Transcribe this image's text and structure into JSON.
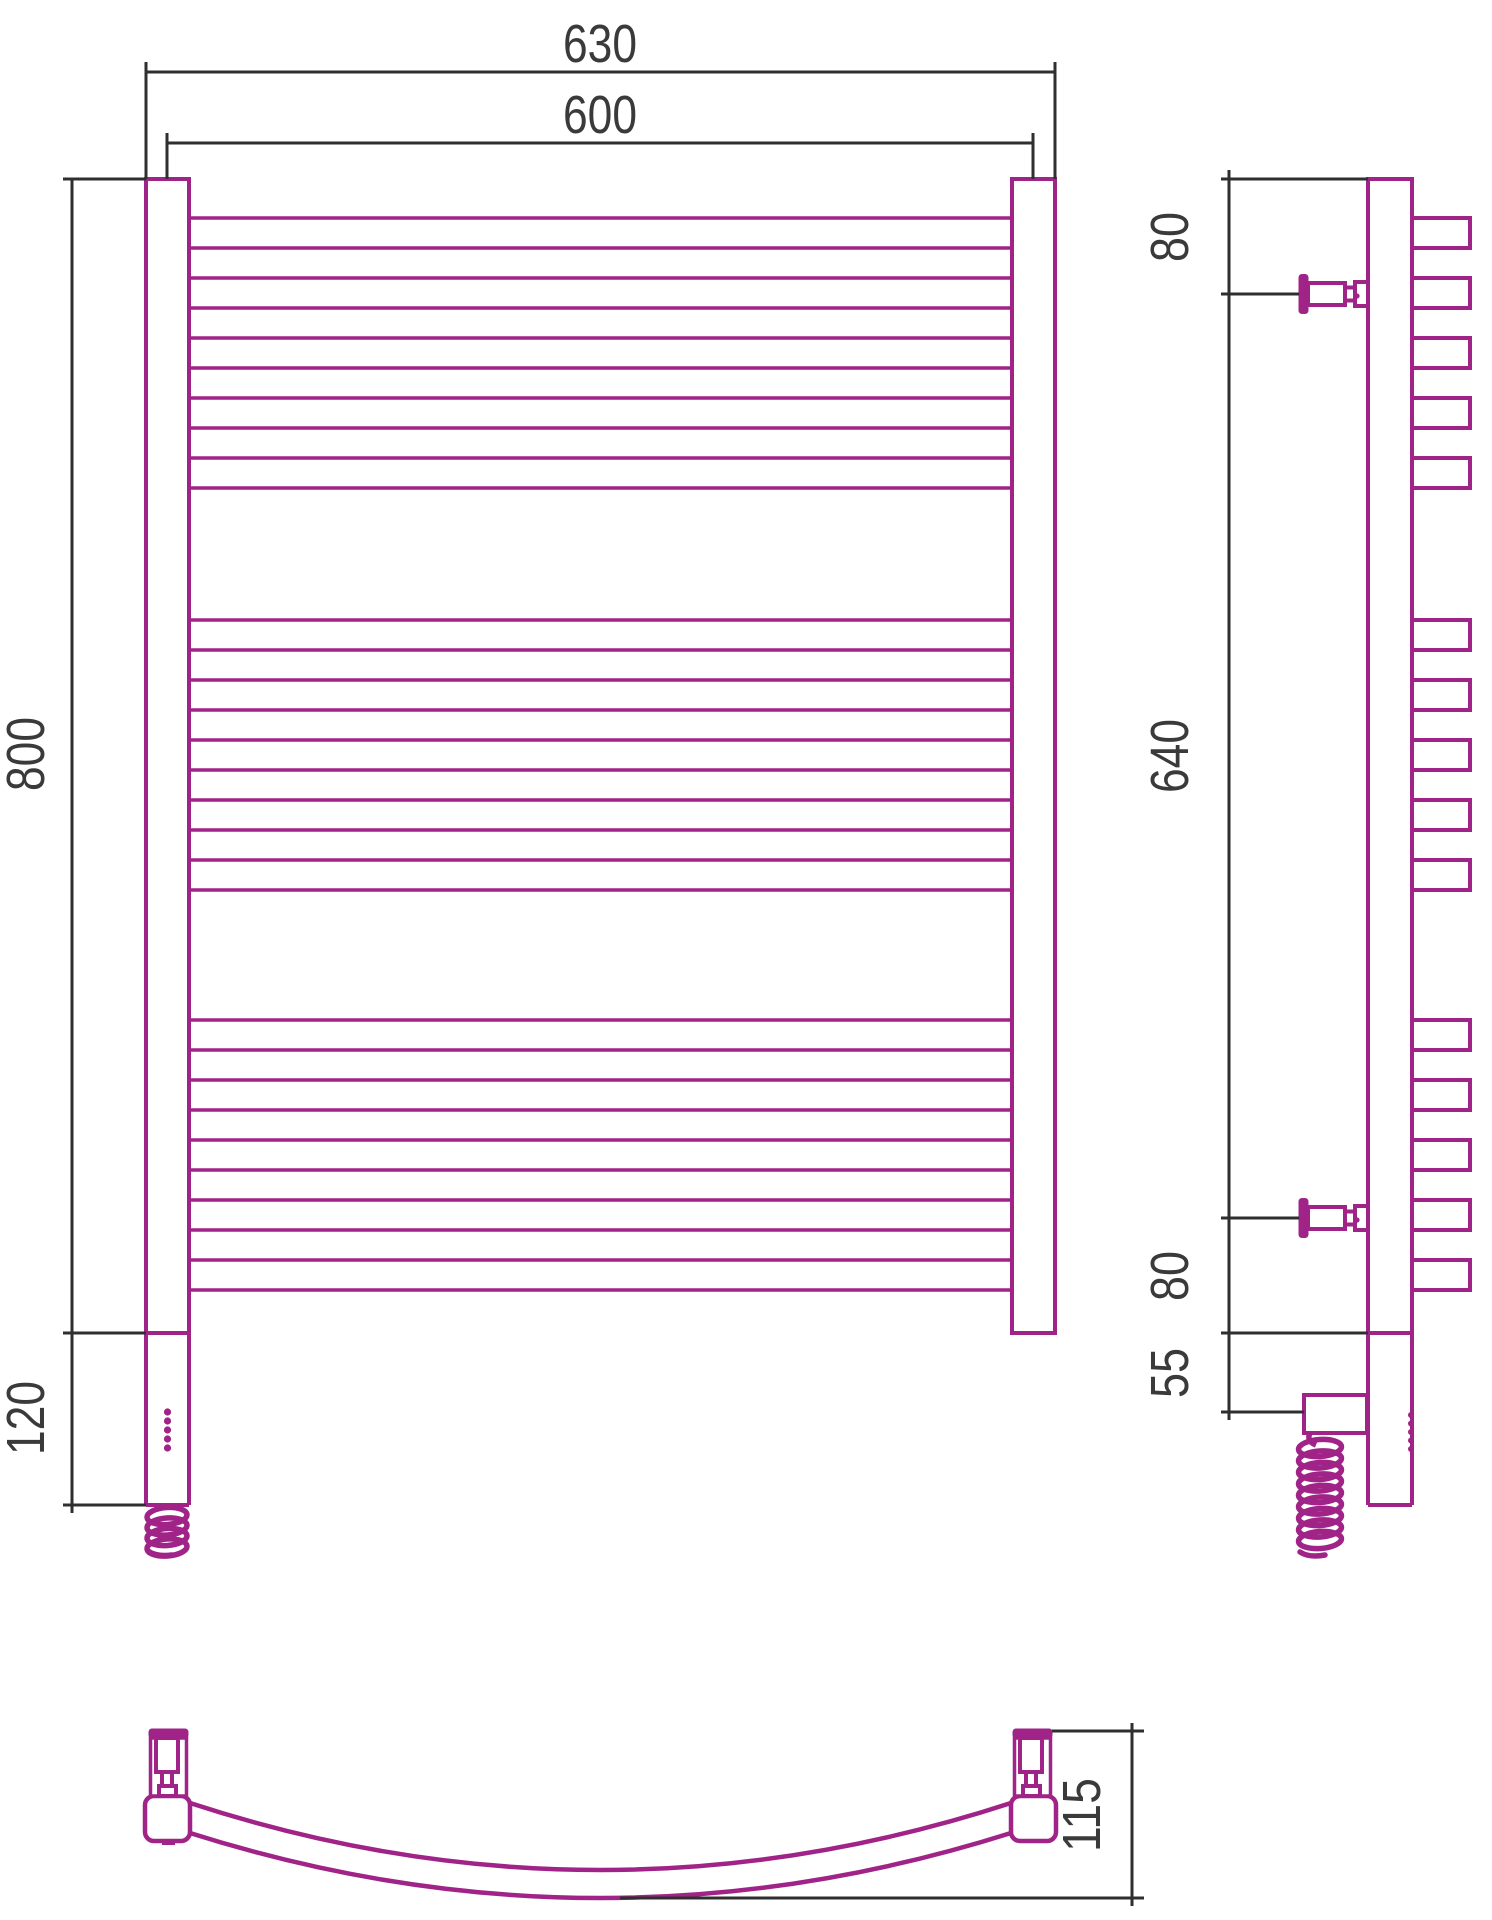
{
  "drawing": {
    "kind": "technical-drawing",
    "subject": "electric heated towel rail",
    "units": "mm",
    "colors": {
      "product_outline": "#A02387",
      "dimension_line": "#2f2f2f",
      "label_text": "#3a3a3a",
      "background": "#ffffff"
    }
  },
  "views": {
    "front": {
      "label": "front-view",
      "dimensions": [
        {
          "id": "overall-width",
          "value": "630"
        },
        {
          "id": "axis-width",
          "value": "600"
        },
        {
          "id": "body-height",
          "value": "800"
        },
        {
          "id": "heater-extension",
          "value": "120"
        }
      ]
    },
    "side": {
      "label": "side-view",
      "dimensions": [
        {
          "id": "top-to-upper-bracket",
          "value": "80"
        },
        {
          "id": "bracket-span",
          "value": "640"
        },
        {
          "id": "lower-bracket-to-bottom",
          "value": "80"
        },
        {
          "id": "bottom-to-cable-box",
          "value": "55"
        }
      ]
    },
    "bottom": {
      "label": "bottom-view",
      "dimensions": [
        {
          "id": "depth",
          "value": "115"
        }
      ]
    }
  },
  "structure": {
    "vertical_rails": 2,
    "bar_groups": 3,
    "bars_per_group": 5,
    "wall_brackets": 2,
    "indicator_dots": 5,
    "has_heating_element": true,
    "has_coiled_power_cable": true,
    "curved_front_profile": true
  }
}
